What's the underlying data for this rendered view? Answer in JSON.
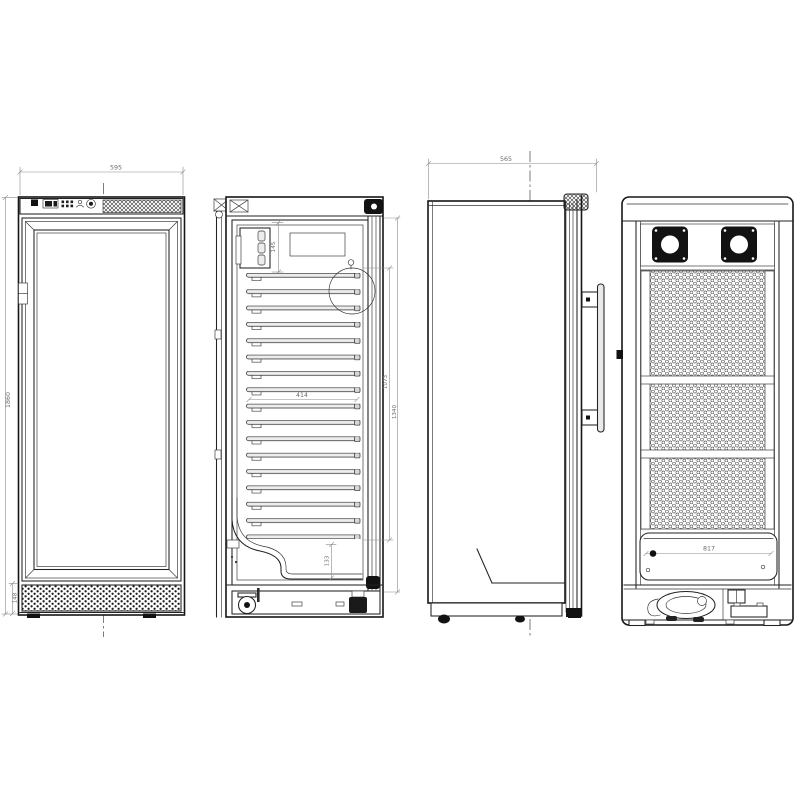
{
  "palette": {
    "background": "#ffffff",
    "line": "#161616",
    "dim_line": "#8a8a8a",
    "dim_text": "#6b6b6b",
    "fill_black": "#121212"
  },
  "views": {
    "front_closed": {
      "dims": {
        "overall_width": "595",
        "overall_height": "1860",
        "grille_height": "148"
      }
    },
    "front_open": {
      "dims": {
        "top_clearance": "145",
        "shelf_width": "414",
        "rail_section_height": "1073",
        "interior_height": "1340",
        "bottom_well_height": "133"
      }
    },
    "side": {
      "dims": {
        "overall_depth": "565"
      }
    },
    "rear": {
      "dims": {
        "condenser_panel_width": "817"
      }
    }
  }
}
